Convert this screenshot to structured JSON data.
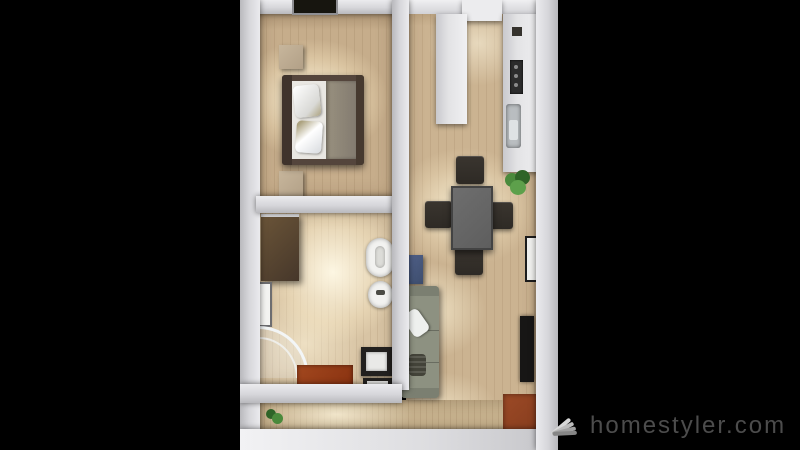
{
  "watermark": {
    "brand": "homestyler.com",
    "logo_icon": "homestyler-fan-logo"
  },
  "scene_type": "3d-floorplan-top-down-render",
  "colors": {
    "bg": "#000000",
    "wall": "#d6d6da",
    "wall_bright": "#ebebee",
    "wall_dim": "#b9b9bd",
    "wallface_tan": "#ab9272",
    "floor_bedroom": "#c6ad8b",
    "floor_bathroom": "#d8c4a4",
    "floor_living": "#cbb391",
    "floor_corridor": "#c7b28e",
    "bed_frame": "#54453c",
    "bed_linen": "#e9e7e2",
    "bed_duvet": "#837b70",
    "pillow_tan": "#aca27f",
    "nightstand": "#b2a087",
    "vanity": "#46372a",
    "ceramic": "#f2f2f0",
    "shower_glass": "#e9eef2",
    "mat_red": "#87300f",
    "washer_dark": "#22201e",
    "counter": "#e3e3e5",
    "cooktop": "#2c2c2c",
    "kitchen_sink": "#b9bdc0",
    "table_gray": "#5e5e5e",
    "chair_dark": "#2e2a25",
    "plant_green": "#4a8a3c",
    "plant_green_dark": "#2f6428",
    "accent_blue": "#3e4e6e",
    "sofa": "#8d9181",
    "sofa_dark": "#75796b",
    "sofa_pillow": "#eef0ee",
    "sofa_pillow_dark": "#434339",
    "tv_dark": "#171615",
    "frame_dark": "#1c1c1c",
    "cabinet_red": "#81391c",
    "watermark_text": "#4c4c4c",
    "watermark_logo": "#c2c2c2"
  }
}
